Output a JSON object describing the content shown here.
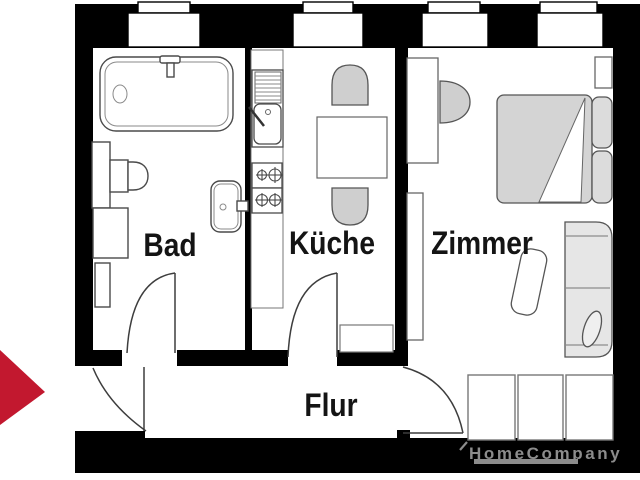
{
  "rooms": [
    {
      "id": "bad",
      "label": "Bad"
    },
    {
      "id": "kueche",
      "label": "Küche"
    },
    {
      "id": "zimmer",
      "label": "Zimmer"
    },
    {
      "id": "flur",
      "label": "Flur"
    }
  ],
  "watermark": {
    "text": "HomeCompany",
    "color": "#8c8c8c"
  },
  "colors": {
    "wall_black": "#000000",
    "arrow_red": "#c2182f",
    "furniture_outline": "#4a4a4a",
    "furniture_gray": "#cfcfcf",
    "bed_gray": "#d4d4d4",
    "sofa_gray": "#e6e6e6",
    "label_text": "#141414"
  },
  "icons": {
    "entrance_arrow": "red triangle pointing right at entrance",
    "bathtub": "bathtub with faucet and drain",
    "toilet": "toilet tank and bowl",
    "washbasin": "washbasin with faucet",
    "washing_machine": "washing machine square",
    "kitchen_sink": "sink unit with drainer and faucet",
    "stove": "four burner stove",
    "dining_table": "table with two chairs",
    "bed": "double bed with pillows and folded blanket",
    "sofa": "sofa with cushion",
    "wardrobe": "three section wardrobe"
  }
}
